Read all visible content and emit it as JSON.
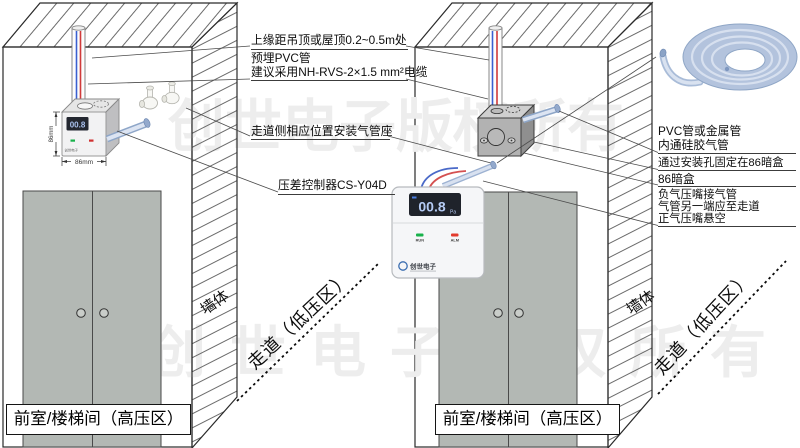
{
  "watermark": {
    "text": "创世电子版权所有",
    "color": "#ededed"
  },
  "rooms": {
    "left": {
      "room_label": "前室/楼梯间（高压区）",
      "wall_label": "墙体",
      "corridor_label": "走道（低压区）"
    },
    "right": {
      "room_label": "前室/楼梯间（高压区）",
      "wall_label": "墙体",
      "corridor_label": "走道（低压区）"
    }
  },
  "device_small": {
    "display_value": "00.8",
    "width_dim": "86mm",
    "height_dim": "86mm",
    "brand": "创世电子"
  },
  "controller": {
    "display_value": "00.8",
    "display_unit": "Pa",
    "run_label": "RUN",
    "alarm_label": "ALM",
    "brand": "创世电子",
    "run_color": "#18b24b",
    "alarm_color": "#e23b2e",
    "display_bg": "#1f232b",
    "display_text_color": "#b5cbf4"
  },
  "callouts_left": {
    "c1": {
      "text": "上缘距吊顶或屋顶0.2~0.5m处"
    },
    "c2": {
      "line1": "预埋PVC管",
      "line2": "建议采用NH-RVS-2×1.5 mm²电缆"
    },
    "c3": {
      "text": "走道侧相应位置安装气管座"
    },
    "c4": {
      "text": "压差控制器CS-Y04D"
    }
  },
  "callouts_right": {
    "c1": {
      "line1": "PVC管或金属管",
      "line2": "内通硅胶气管"
    },
    "c2": {
      "text": "通过安装孔固定在86暗盒"
    },
    "c3": {
      "text": "86暗盒"
    },
    "c4": {
      "line1": "负气压嘴接气管",
      "line2": "气管另一端应至走道",
      "line3": "正气压嘴悬空"
    }
  }
}
